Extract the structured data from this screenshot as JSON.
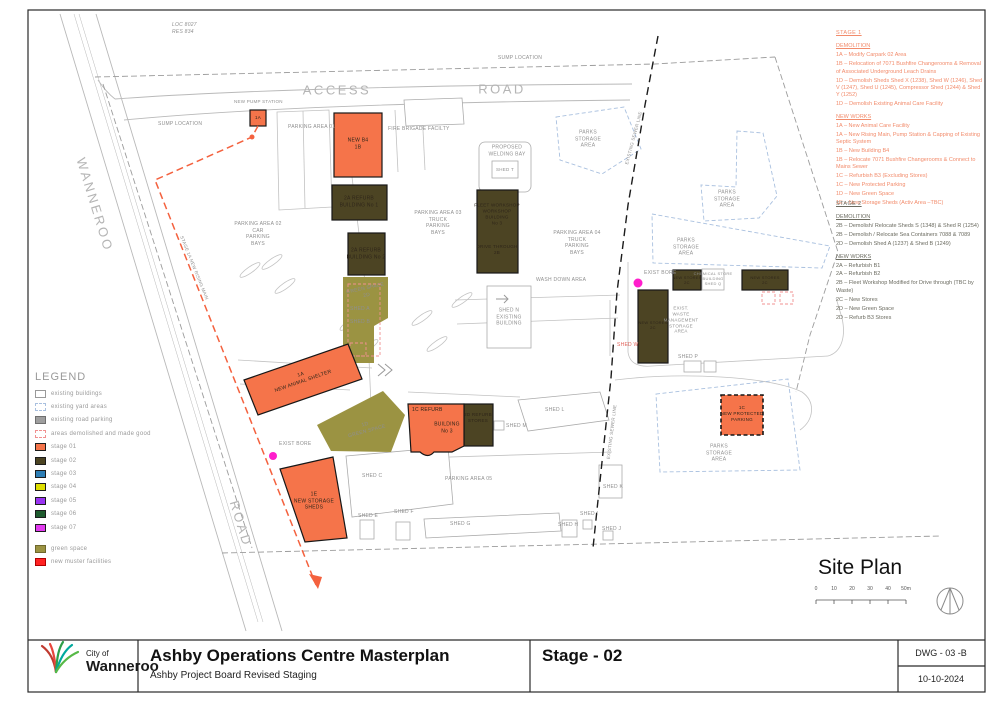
{
  "colors": {
    "stage01": "#F5744A",
    "stage02": "#4C4423",
    "stage03": "#2D7EB5",
    "stage04": "#DEDE00",
    "stage05": "#9933F2",
    "stage06": "#1E5B2E",
    "stage07": "#E23BF0",
    "green_space": "#9B9342",
    "muster": "#FF2222",
    "notes_orange": "#F28B6B",
    "magenta_marker": "#FF1ECC"
  },
  "plan": {
    "labels": {
      "loc": "LOC 8027\nRES   834",
      "sump_top": "SUMP LOCATION",
      "access": "ACCESS",
      "road_top": "ROAD",
      "wanneroo": "WANNEROO",
      "road_left": "ROAD",
      "new_pump_station": "NEW PUMP STATION",
      "sump_left": "SUMP LOCATION",
      "parking01": "PARKING AREA 01",
      "fire_brigade": "FIRE BRIGADE FACILTY",
      "welding_bay": "PROPOSED\nWELDING BAY",
      "shed_t": "SHED T",
      "parks_storage": "PARKS\nSTORAGE\nAREA",
      "parking02": "PARKING AREA 02\nCAR\nPARKING\nBAYS",
      "parking03": "PARKING AREA 03\nTRUCK\nPARKING\nBAYS",
      "parking04": "PARKING AREA 04\nTRUCK\nPARKING\nBAYS",
      "parking05": "PARKING AREA 05",
      "wash_down": "WASH DOWN AREA",
      "shed_n": "SHED N\nEXISTING\nBUILDING",
      "exist_bore": "EXIST BORE",
      "exist_waste": "EXIST.\nWASTE\nMANAGEMENT\nSTORAGE\nAREA",
      "chemical_store": "CHEMICAL STORE\nBUILDING\nSHED Q",
      "shed_p": "SHED P",
      "shed_w": "SHED W",
      "shed_l": "SHED L",
      "shed_m": "SHED M",
      "shed_c": "SHED C",
      "shed_e": "SHED E",
      "shed_f": "SHED F",
      "shed_g": "SHED G",
      "shed_h": "SHED H",
      "shed_i": "SHED I",
      "shed_j": "SHED J",
      "shed_k": "SHED K",
      "sewer_line": "EXISTING SEWER LINE",
      "rising_main": "STAGE 1A NEW RISING MAIN",
      "green_strip": "GREEN SPACE\n2D",
      "shed_a": "SHED A",
      "shed_b": "SHED B",
      "green_1d": "1D\nGREEN SPACE"
    },
    "buildings": {
      "pump_tag": "1A",
      "b4": "NEW B4\n1B",
      "refurb1": "2A REFURB\nBUILDING No 1",
      "refurb2": "2A REFURB\nBUILDING No 2",
      "fleet": "FLEET WORKSHOP\nWORKSHOP\nBUILDING\nNo 3",
      "drive_through": "DRIVE THROUGH\n2B",
      "animal_shelter": "1A\nNEW ANIMAL SHELTER",
      "b3_tag": "1C REFURB",
      "b3_name": "BUILDING\nNo 3",
      "stores_2d": "2D REFURB\nSTORES",
      "storage_1e": "1E\nNEW STORAGE\nSHEDS",
      "protected_parking": "1C\nNEW PROTECTED\nPARKING",
      "new_stores_2c": "NEW STORES\n2C"
    }
  },
  "notes": {
    "stage1": {
      "title": "STAGE 1",
      "demolition_heading": "DEMOLITION",
      "demolition": [
        "1A – Modify Carpark 02 Area",
        "1B – Relocation of 7071 Bushfire Changerooms & Removal of Associated Underground Leach Drains",
        "1D – Demolish Sheds Shed X (1238), Shed W (1246), Shed V (1247), Shed U (1245), Compressor Shed (1244) & Shed Y (1252)",
        "1D – Demolish Existing Animal Care Facility"
      ],
      "new_works_heading": "NEW WORKS",
      "new_works": [
        "1A – New Animal Care Facility",
        "1A – New Rising Main, Pump Station & Capping of Existing Septic System",
        "1B – New Building B4",
        "1B – Relocate 7071 Bushfire Changerooms & Connect to Mains Sewer",
        "1C – Refurbish B3 (Excluding Stores)",
        "1C – New Protected Parking",
        "1D – New Green Space",
        "1E – New Storage Sheds (Activ Area –TBC)"
      ]
    },
    "stage2": {
      "title": "STAGE 2",
      "demolition_heading": "DEMOLITION",
      "demolition": [
        "2B – Demolish/ Relocate Sheds S (1348) & Shed R (1254)",
        "2B – Demolish / Relocate Sea Containers 7088 & 7089",
        "2D – Demolish Shed A (1237) & Shed B (1249)"
      ],
      "new_works_heading": "NEW WORKS",
      "new_works": [
        "2A – Refurbish B1",
        "2A – Refurbish B2",
        "2B – Fleet Workshop Modified for Drive through (TBC by Waste)",
        "2C – New Stores",
        "2D – New Green Space",
        "2D – Refurb B3 Stores"
      ]
    }
  },
  "legend": {
    "title": "LEGEND",
    "items": [
      {
        "label": "existing buildings",
        "swatch_class": "sw sw-existing"
      },
      {
        "label": "existing yard areas",
        "swatch_class": "sw sw-yard"
      },
      {
        "label": "existing road parking",
        "swatch_class": "sw sw-roadpark"
      },
      {
        "label": "areas demolished and made good",
        "swatch_class": "sw sw-demolished"
      },
      {
        "label": "stage 01",
        "swatch_class": "sw sw-stage01"
      },
      {
        "label": "stage 02",
        "swatch_class": "sw sw-stage02"
      },
      {
        "label": "stage 03",
        "swatch_class": "sw sw-stage03"
      },
      {
        "label": "stage 04",
        "swatch_class": "sw sw-stage04"
      },
      {
        "label": "stage 05",
        "swatch_class": "sw sw-stage05"
      },
      {
        "label": "stage 06",
        "swatch_class": "sw sw-stage06"
      },
      {
        "label": "stage 07",
        "swatch_class": "sw sw-stage07"
      },
      {
        "label": "green space",
        "swatch_class": "sw sw-green"
      },
      {
        "label": "new muster facilities",
        "swatch_class": "sw sw-muster"
      }
    ]
  },
  "site_plan": {
    "title": "Site Plan",
    "scale_ticks": [
      "0",
      "10",
      "20",
      "30",
      "40",
      "50m"
    ]
  },
  "title_block": {
    "logo_line1": "City of",
    "logo_line2": "Wanneroo",
    "project_title": "Ashby Operations Centre Masterplan",
    "project_subtitle": "Ashby Project Board Revised Staging",
    "stage_label": "Stage - 02",
    "dwg_number": "DWG - 03 -B",
    "date": "10-10-2024"
  }
}
